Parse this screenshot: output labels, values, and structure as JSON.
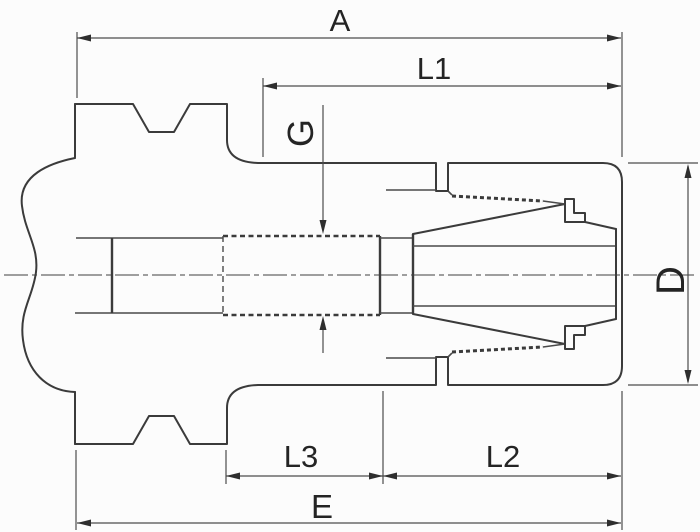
{
  "drawing": {
    "type": "technical-dimension-drawing",
    "subject": "collet chuck tap holder side section view",
    "background": "#fcfcfc",
    "line_color": "#3b3b3b",
    "dimension_color": "#4d4d4d",
    "text_color": "#242424"
  },
  "dimensions": {
    "A": {
      "label": "A",
      "orientation": "horizontal",
      "position": "top-full-width"
    },
    "L1": {
      "label": "L1",
      "orientation": "horizontal",
      "position": "top-front-section"
    },
    "G": {
      "label": "G",
      "orientation": "vertical-rotated",
      "position": "center-thread-callout"
    },
    "D": {
      "label": "D",
      "orientation": "vertical-rotated",
      "position": "right-diameter"
    },
    "L3": {
      "label": "L3",
      "orientation": "horizontal",
      "position": "bottom-middle-section"
    },
    "L2": {
      "label": "L2",
      "orientation": "horizontal",
      "position": "bottom-front-section"
    },
    "E": {
      "label": "E",
      "orientation": "horizontal",
      "position": "bottom-full-width"
    }
  }
}
